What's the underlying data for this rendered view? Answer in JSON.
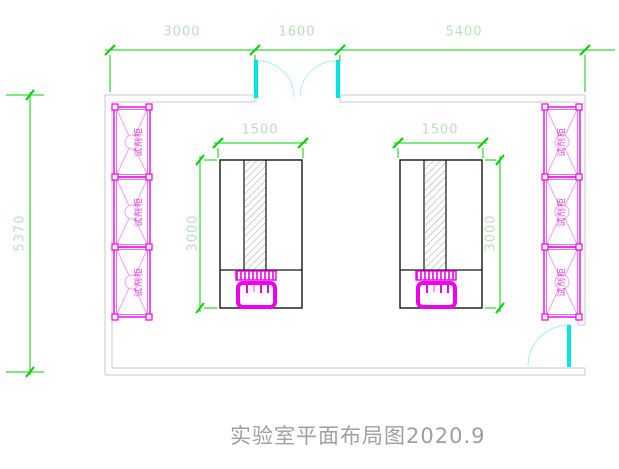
{
  "drawing": {
    "title": "实验室平面布局图2020.9"
  },
  "dims": {
    "top_left": "3000",
    "top_mid": "1600",
    "top_right": "5400",
    "overall_height": "5370",
    "bench_left_width": "1500",
    "bench_right_width": "1500",
    "bench_left_height": "3000",
    "bench_right_height": "3000"
  },
  "cabinets": {
    "label": "试剂柜"
  },
  "colors": {
    "dimension_line": "#00d200",
    "dimension_text": "#bcdebc",
    "wall": "#c9c9c9",
    "door_leaf": "#00e6e6",
    "door_arc": "#a8eff0",
    "cabinet": "#ee00ee",
    "cabinet_light": "#f5a0f5",
    "bench_outline": "#141414",
    "sink": "#ee00ee",
    "title_text": "#9f9f9f"
  }
}
